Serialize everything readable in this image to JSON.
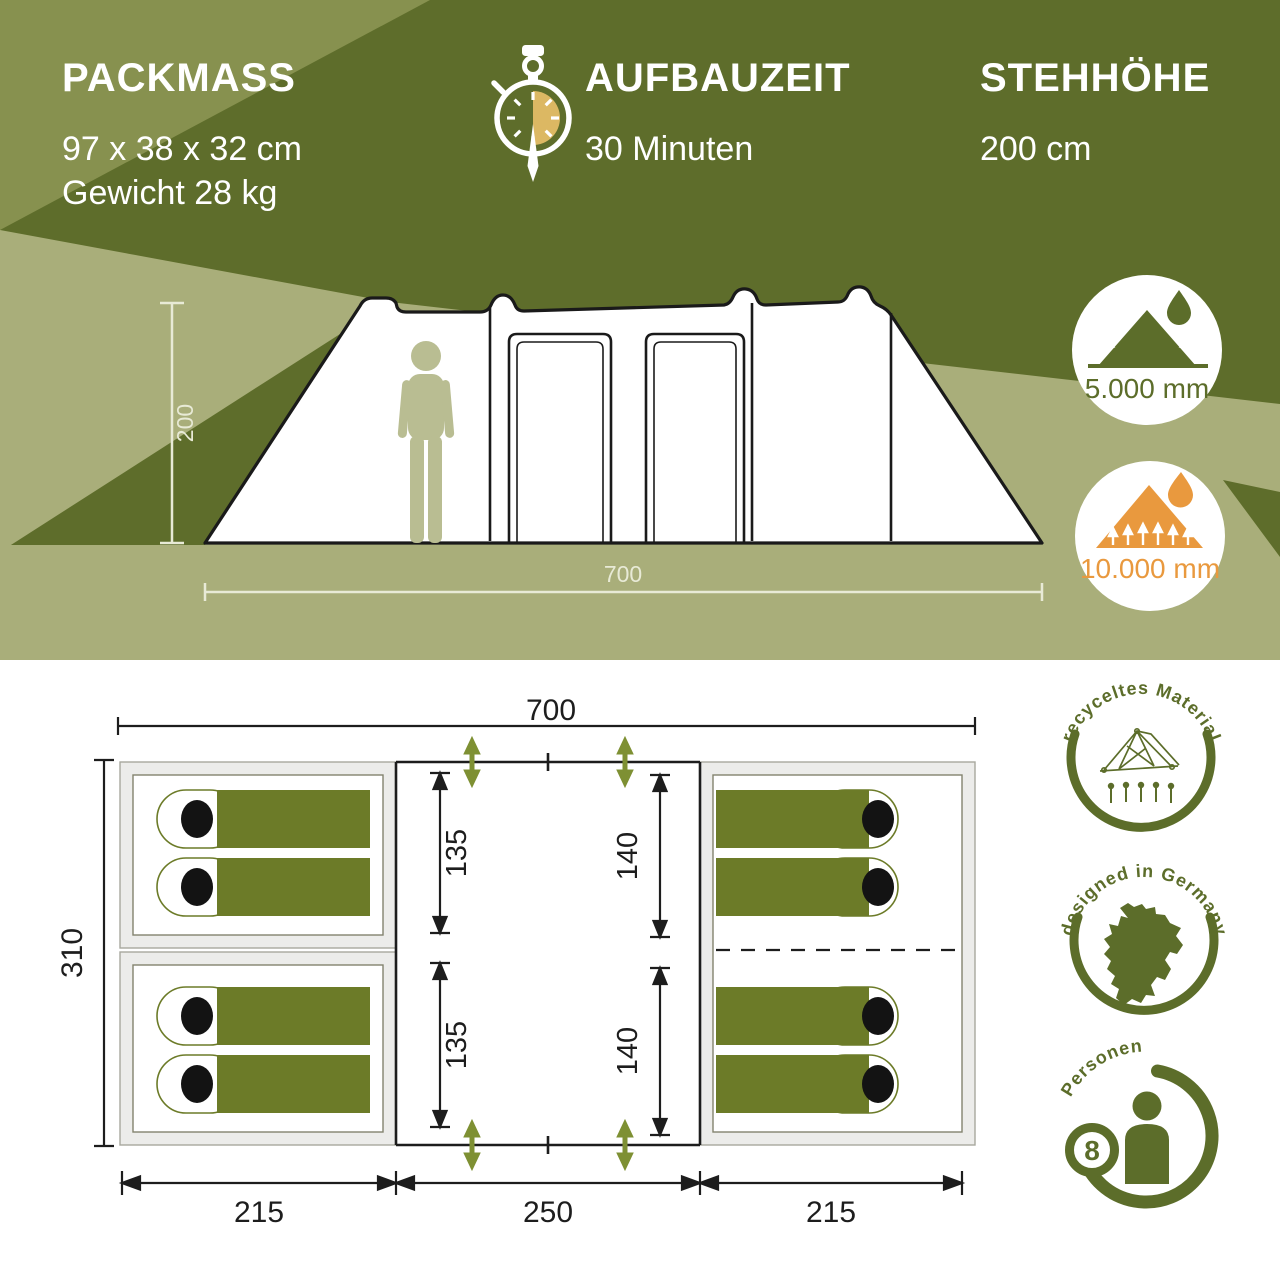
{
  "specs": {
    "packmass": {
      "title": "PACKMASS",
      "dimensions": "97 x 38 x 32 cm",
      "weight": "Gewicht 28 kg"
    },
    "aufbauzeit": {
      "title": "AUFBAUZEIT",
      "value": "30 Minuten",
      "icon": "stopwatch-icon"
    },
    "stehhoehe": {
      "title": "STEHHÖHE",
      "value": "200 cm"
    }
  },
  "side_view": {
    "height_label": "200",
    "width_label": "700"
  },
  "water_column_badges": {
    "flysheet": {
      "value": "5.000 mm",
      "color": "#5c6d2a",
      "icon": "rain-runoff-mountain-icon"
    },
    "groundsheet": {
      "value": "10.000 mm",
      "color": "#e9993e",
      "icon": "ground-moisture-mountain-icon"
    }
  },
  "floor_plan": {
    "width_total": "700",
    "depth_total": "310",
    "segment_widths": [
      "215",
      "250",
      "215"
    ],
    "left_cabin_depths": [
      "135",
      "135"
    ],
    "right_cabin_depths": [
      "140",
      "140"
    ]
  },
  "feature_badges": {
    "material": {
      "label": "recyceltes Material",
      "icon": "tent-line-icon"
    },
    "design": {
      "label": "designed in Germany",
      "icon": "germany-map-icon"
    },
    "persons": {
      "label": "Personen",
      "count": "8",
      "icon": "person-icon"
    }
  },
  "colors": {
    "olive_dark": "#5e6d2b",
    "olive_mid": "#87914f",
    "sage": "#a9ae7a",
    "bag_olive": "#6c7b28",
    "arrow_green": "#7e9033",
    "badge_olive": "#5c6d2a",
    "accent_orange": "#e9993e",
    "stopwatch_gold": "#dcb863",
    "person_pale": "#b9bd92"
  }
}
